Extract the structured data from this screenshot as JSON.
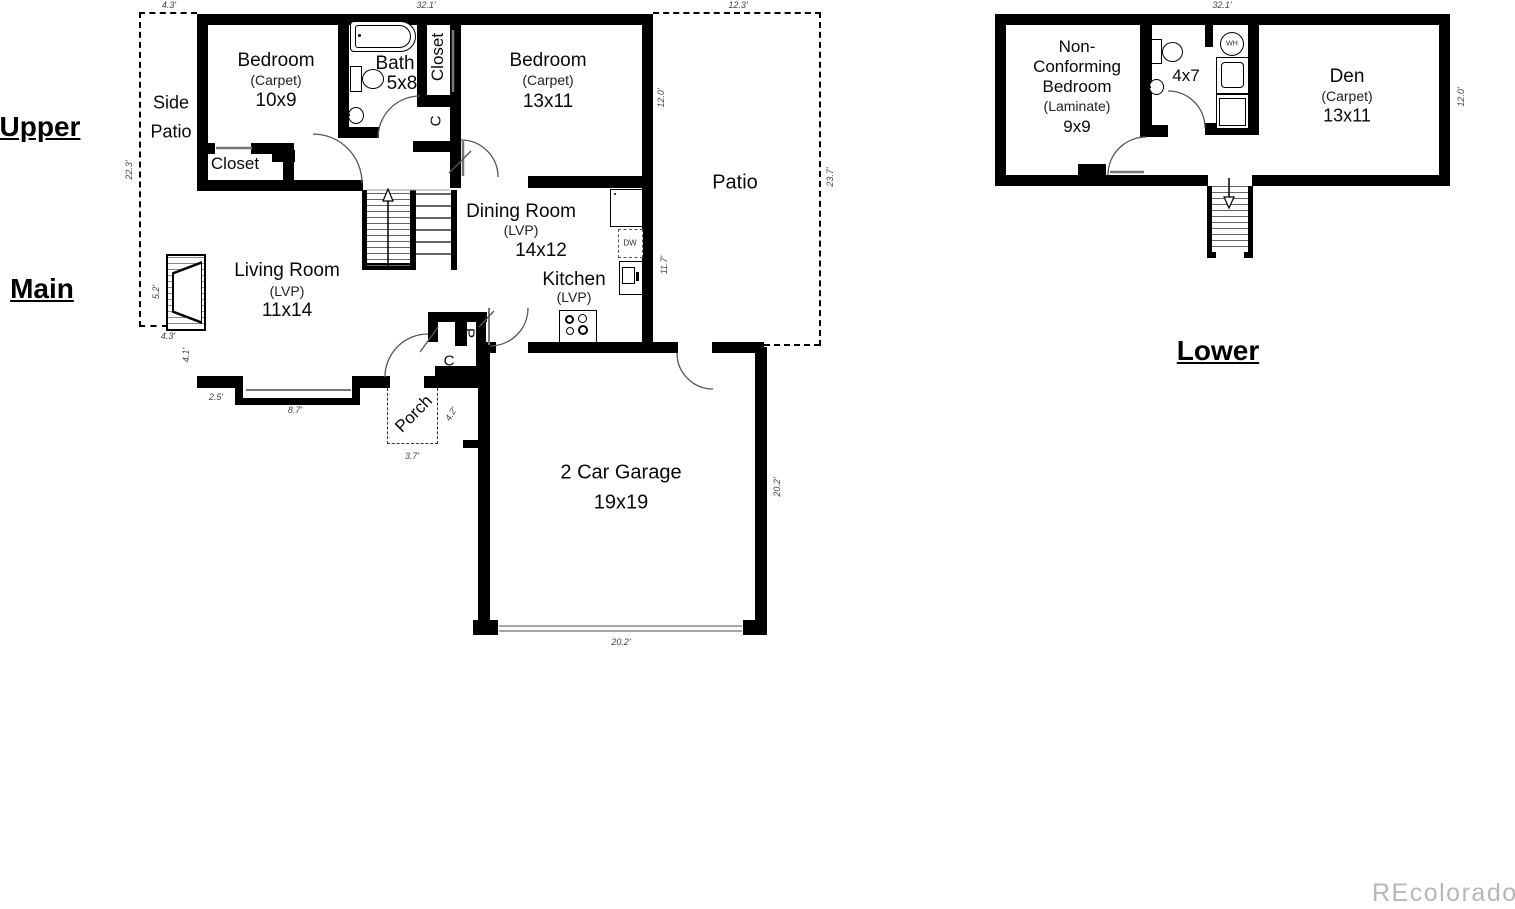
{
  "section_labels": {
    "upper": "Upper",
    "main": "Main",
    "lower": "Lower"
  },
  "watermark": "REcolorado",
  "main_floor": {
    "rooms": {
      "bedroom1": {
        "name": "Bedroom",
        "finish": "(Carpet)",
        "size": "10x9"
      },
      "bath": {
        "name": "Bath",
        "size": "5x8"
      },
      "hall_closet": {
        "name": "Closet"
      },
      "hall_closet_c": {
        "name": "C"
      },
      "bedroom2": {
        "name": "Bedroom",
        "finish": "(Carpet)",
        "size": "13x11"
      },
      "side_patio": {
        "line1": "Side",
        "line2": "Patio"
      },
      "bedroom1_closet": {
        "name": "Closet"
      },
      "living_room": {
        "name": "Living Room",
        "finish": "(LVP)",
        "size": "11x14"
      },
      "dining_room": {
        "name": "Dining Room",
        "finish": "(LVP)",
        "size": "14x12"
      },
      "kitchen": {
        "name": "Kitchen",
        "finish": "(LVP)"
      },
      "patio": {
        "name": "Patio"
      },
      "porch": {
        "name": "Porch"
      },
      "pantry": {
        "name": "P"
      },
      "coat_closet": {
        "name": "C"
      },
      "garage": {
        "name": "2 Car Garage",
        "size": "19x19"
      },
      "dishwasher": {
        "name": "DW"
      }
    },
    "dimensions": {
      "side_patio_top": "4.3'",
      "top": "32.1'",
      "patio_top": "12.3'",
      "side_patio_left": "22.3'",
      "bedroom2_right": "12.0'",
      "patio_right": "23.7'",
      "kitchen_right": "11.7'",
      "fireplace_left": "5.2'",
      "below_side_patio": "4.3'",
      "living_left": "4.1'",
      "bay_left": "2.5'",
      "bay_bottom": "8.7'",
      "porch_bottom": "3.7'",
      "porch_right": "4.2'",
      "garage_right": "20.2'",
      "garage_bottom": "20.2'"
    }
  },
  "lower_floor": {
    "rooms": {
      "nc_bedroom": {
        "line1": "Non-",
        "line2": "Conforming",
        "line3": "Bedroom",
        "finish": "(Laminate)",
        "size": "9x9"
      },
      "bath": {
        "size": "4x7"
      },
      "water_heater": {
        "name": "WH"
      },
      "den": {
        "name": "Den",
        "finish": "(Carpet)",
        "size": "13x11"
      }
    },
    "dimensions": {
      "top": "32.1'",
      "den_right": "12.0'"
    }
  }
}
